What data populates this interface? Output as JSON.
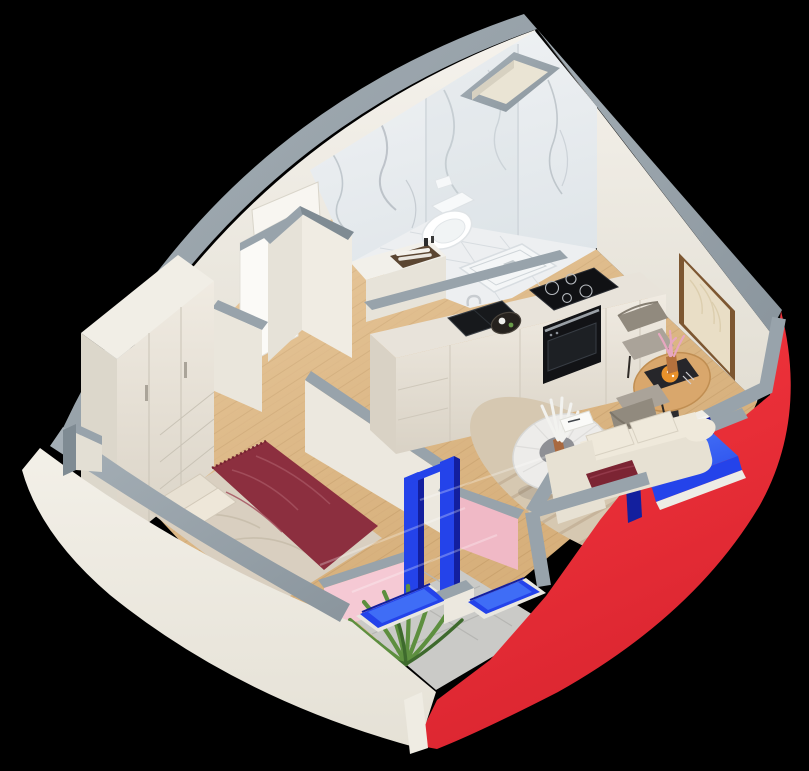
{
  "canvas": {
    "width": 809,
    "height": 771
  },
  "scene": {
    "kind": "isometric-3d-floorplan-render",
    "rooms": [
      "bathroom",
      "kitchen",
      "living-dining",
      "bedroom",
      "hallway",
      "balcony"
    ],
    "objects": [
      "curved-exterior-wall-white",
      "curved-exterior-wall-red",
      "gray-wall-caps",
      "marble-bathroom-walls",
      "wall-hung-toilet",
      "shower-tray",
      "vanity-with-towel-basket",
      "kitchen-counter",
      "induction-hob",
      "built-in-oven",
      "kitchen-sink",
      "serving-tray",
      "round-dining-table",
      "two-gray-chairs",
      "flower-vase",
      "menu-board",
      "picture-frame",
      "beige-sofa",
      "red-cushion",
      "round-coffee-table",
      "striped-rug",
      "double-bed",
      "burgundy-throw",
      "pillows",
      "wardrobe",
      "open-door",
      "pink-balcony-walls",
      "blue-window-frames",
      "glass-panes",
      "balcony-tile-floor",
      "green-plant",
      "wood-plank-floor",
      "ventilation-shaft-niche",
      "wall-niche"
    ]
  },
  "palette": {
    "background": "#000000",
    "wall_top_gray": "#98a3ab",
    "wall_top_gray_dark": "#7f8b93",
    "wall_white": "#f1eee6",
    "wall_white_shade": "#dfdbd0",
    "wall_face_top": "#f5f2ec",
    "wall_face_bottom": "#e2ded3",
    "exterior_top": "#f3f0e8",
    "exterior_bottom": "#e5e1d6",
    "marble_light": "#f1f3f5",
    "marble_dark": "#dfe5e9",
    "marble_floor": "#edeff1",
    "marble_vein": "#a7b0b8",
    "floor_wood": "#e2b983",
    "floor_wood_line": "#c59a64",
    "accent_red": "#f5333c",
    "accent_red_dark": "#da2530",
    "frame_blue": "#2443ea",
    "frame_blue_bright": "#3f6df6",
    "frame_blue_deep": "#131f9e",
    "wall_pink": "#f0b9c6",
    "wall_pink_light": "#f5c9d4",
    "balcony_tile": "#cacac7",
    "balcony_tile_line": "#b6b6b3",
    "rug_beige": "#d6c8b1",
    "rug_stripe": "#c2b096",
    "sofa_beige": "#e7e1d3",
    "sofa_beige_light": "#efe9db",
    "cushion_red": "#7c2433",
    "bed_duvet": "#d9cfc0",
    "bed_throw": "#8c2f3f",
    "bed_throw_fold": "#a5525f",
    "pillow": "#e8e1d3",
    "wood_table": "#d9a76c",
    "chair_gray": "#aaa399",
    "chair_gray_dark": "#918a7e",
    "counter_top": "#e8e3da",
    "counter_front_top": "#f0ebe2",
    "counter_front_bottom": "#d9d2c5",
    "appliance_black": "#15161a",
    "steel": "#c8ccd0",
    "plant_green": "#5d8f3f",
    "plant_green_dark": "#3e6a2d",
    "art_tan": "#e9dec6",
    "frame_brown": "#7d5731",
    "basket_brown": "#5b4632",
    "glass_reflection": "#ffffff"
  }
}
